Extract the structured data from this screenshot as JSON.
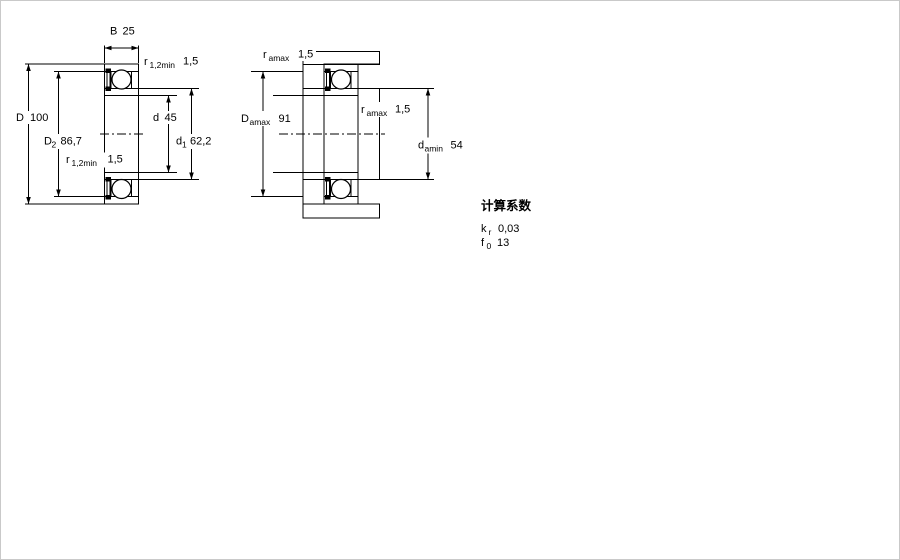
{
  "drawing": {
    "description": "deep groove ball bearing cross-section drawings",
    "colors": {
      "line": "#000000",
      "hatch_light": "#bed3e4",
      "hatch_dark": "#8fb0ca",
      "background": "#ffffff"
    },
    "left_view": {
      "b": {
        "sym": "B",
        "val": "25"
      },
      "r_top": {
        "sym": "r",
        "sub": "1,2min",
        "val": "1,5"
      },
      "D": {
        "sym": "D",
        "val": "100"
      },
      "D2": {
        "sym": "D",
        "sub": "2",
        "val": "86,7"
      },
      "d": {
        "sym": "d",
        "val": "45"
      },
      "d1": {
        "sym": "d",
        "sub": "1",
        "val": "62,2"
      },
      "r_bot": {
        "sym": "r",
        "sub": "1,2min",
        "val": "1,5"
      }
    },
    "right_view": {
      "r_top": {
        "sym": "r",
        "sub": "amax",
        "val": "1,5"
      },
      "Da": {
        "sym": "D",
        "sub": "amax",
        "val": "91"
      },
      "r_mid": {
        "sym": "r",
        "sub": "amax",
        "val": "1,5"
      },
      "da": {
        "sym": "d",
        "sub": "amin",
        "val": "54"
      }
    },
    "factors": {
      "title": "计算系数",
      "kr": {
        "sym": "k",
        "sub": "r",
        "val": "0,03"
      },
      "f0": {
        "sym": "f",
        "sub": "0",
        "val": "13"
      }
    }
  }
}
